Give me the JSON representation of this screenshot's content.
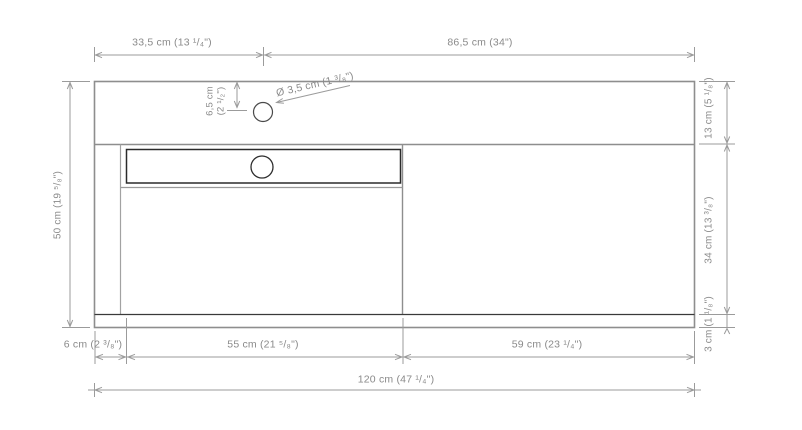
{
  "drawing": {
    "type": "technical-dimension-drawing",
    "subject": "washbasin vanity unit - front view",
    "colors": {
      "outline": "#8e8e8e",
      "dark_line": "#2e2e2e",
      "dimension_line": "#9b9b9b",
      "label_text": "#8a8a8a",
      "background": "#ffffff"
    },
    "dimensions": {
      "top_left": "33,5 cm (13 ¹/₄\")",
      "top_right": "86,5 cm (34\")",
      "left_height": "50 cm (19 ⁵/₈\")",
      "faucet_offset_line1": "6,5 cm",
      "faucet_offset_line2": "(2 ¹/₂\")",
      "faucet_diameter": "Ø 3,5 cm (1 ³/₈\")",
      "right_top": "13 cm (5 ¹/₈\")",
      "right_middle": "34 cm (13 ³/₈\")",
      "right_bottom": "3 cm (1 ¹/₈\")",
      "bottom_left": "6 cm (2 ³/₈\")",
      "bottom_middle": "55 cm (21 ⁵/₈\")",
      "bottom_right": "59 cm (23 ¹/₄\")",
      "bottom_total": "120 cm (47 ¹/₄\")"
    }
  }
}
